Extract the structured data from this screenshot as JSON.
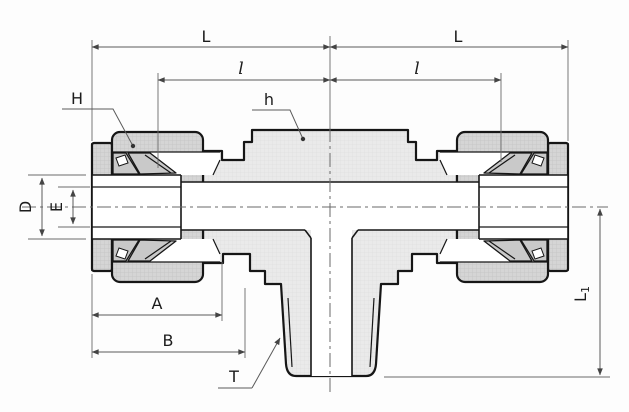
{
  "drawing": {
    "labels": {
      "L_left": "L",
      "L_right": "L",
      "l_left": "l",
      "l_right": "l",
      "H": "H",
      "h": "h",
      "D": "D",
      "E": "E",
      "A": "A",
      "B": "B",
      "T": "T",
      "L1_main": "L",
      "L1_sub": "1"
    },
    "colors": {
      "outline": "#161616",
      "dimension_line": "#5a5a5a",
      "body_fill": "#eaeaea",
      "nut_fill": "#d5d5d5",
      "ferrule_fill": "#c9c9c9",
      "background": "#fdfdfd"
    }
  }
}
